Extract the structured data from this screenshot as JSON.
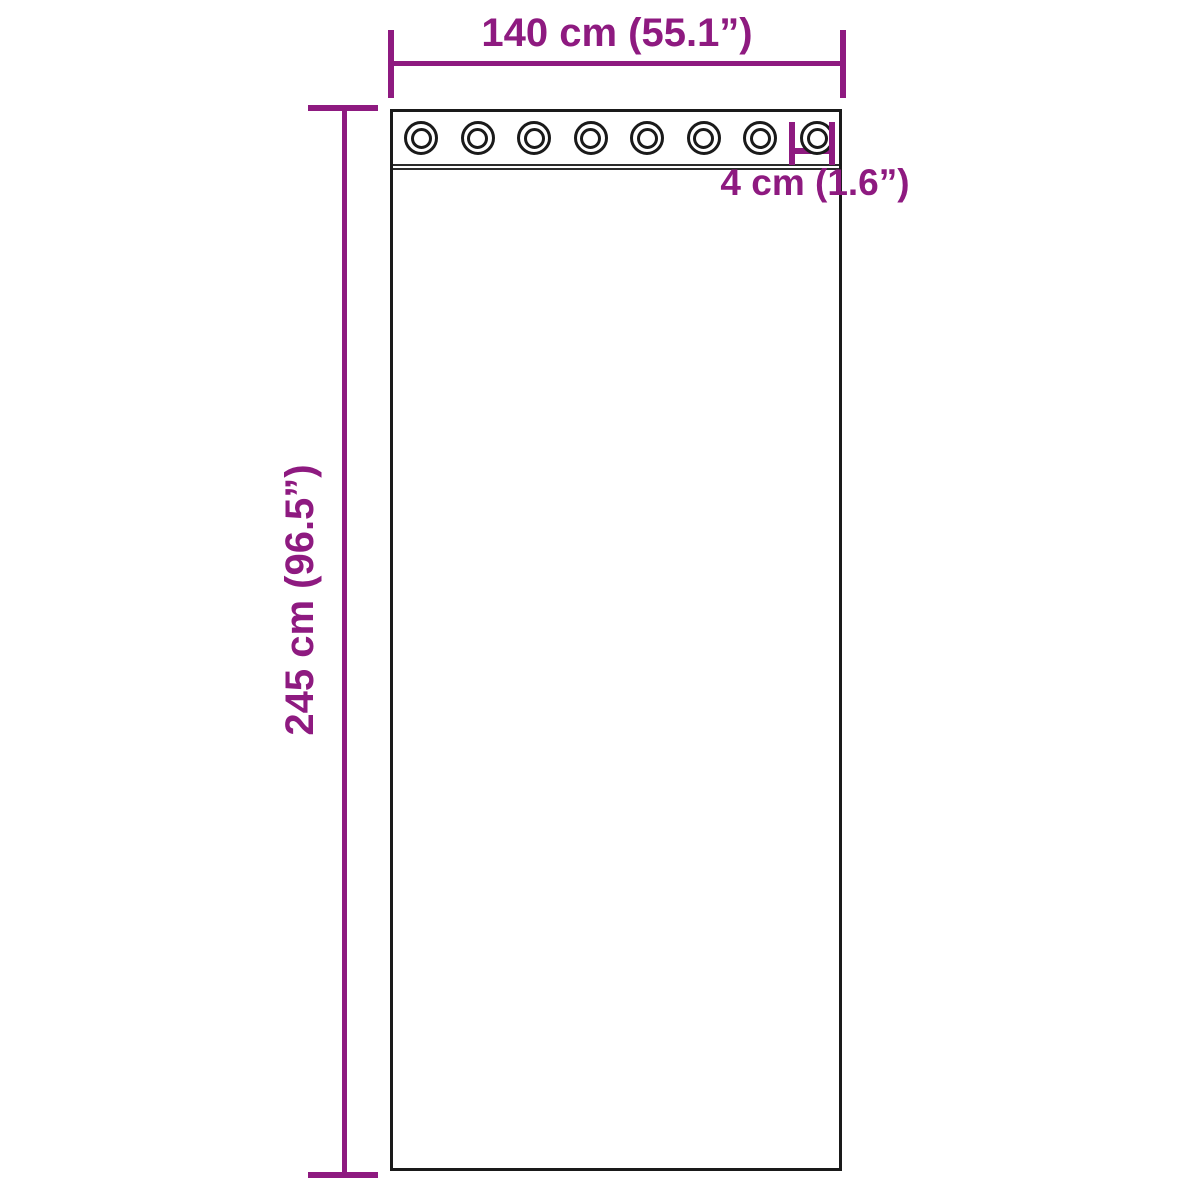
{
  "diagram": {
    "subject": "curtain-panel-with-grommets",
    "colors": {
      "accent": "#8e1a80",
      "outline": "#1a1a1a",
      "background": "#ffffff"
    },
    "panel": {
      "grommet_count": 8
    },
    "dimensions": {
      "width": {
        "label": "140 cm (55.1”)",
        "value_cm": 140,
        "value_in": 55.1
      },
      "height": {
        "label": "245 cm (96.5”)",
        "value_cm": 245,
        "value_in": 96.5
      },
      "grommet": {
        "label": "4 cm (1.6”)",
        "value_cm": 4,
        "value_in": 1.6
      }
    }
  }
}
